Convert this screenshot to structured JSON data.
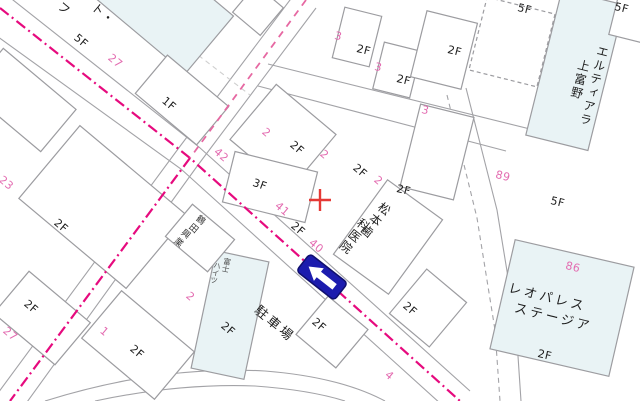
{
  "map": {
    "style": "japanese-residential-map",
    "colors": {
      "background": "#ffffff",
      "building_outline": "#9c9ca0",
      "building_fill_highlight": "#e9f3f5",
      "boundary_magenta_dashdot": "#e60a7e",
      "boundary_pink_dashed": "#e668a2",
      "lot_number_pink": "#e36bb0",
      "floor_label_black": "#1d1d1d",
      "one_way_sign_blue": "#1c1cae",
      "cross_marker_red": "#e53935"
    },
    "one_way_sign": {
      "icon": "one-way-left-arrow"
    },
    "cross_marker": {
      "symbol": "+"
    },
    "labels": [
      {
        "text": "27",
        "kind": "lot",
        "x": 113,
        "y": 52,
        "r": 40
      },
      {
        "text": "23",
        "kind": "lot",
        "x": 4,
        "y": 174,
        "r": 40
      },
      {
        "text": "42",
        "kind": "lot",
        "x": 219,
        "y": 146,
        "r": 40
      },
      {
        "text": "41",
        "kind": "lot",
        "x": 280,
        "y": 200,
        "r": 40
      },
      {
        "text": "40",
        "kind": "lot",
        "x": 314,
        "y": 237,
        "r": 40
      },
      {
        "text": "2",
        "kind": "lot",
        "x": 267,
        "y": 126,
        "r": 40
      },
      {
        "text": "2",
        "kind": "lot",
        "x": 325,
        "y": 148,
        "r": 40
      },
      {
        "text": "2",
        "kind": "lot",
        "x": 379,
        "y": 174,
        "r": 40
      },
      {
        "text": "3",
        "kind": "lot",
        "x": 336,
        "y": 30,
        "r": 14
      },
      {
        "text": "3",
        "kind": "lot",
        "x": 376,
        "y": 61,
        "r": 14
      },
      {
        "text": "3",
        "kind": "lot",
        "x": 423,
        "y": 104,
        "r": 14
      },
      {
        "text": "2",
        "kind": "lot",
        "x": 191,
        "y": 290,
        "r": 40
      },
      {
        "text": "27",
        "kind": "lot",
        "x": 8,
        "y": 325,
        "r": 40
      },
      {
        "text": "1",
        "kind": "lot",
        "x": 105,
        "y": 325,
        "r": 40
      },
      {
        "text": "89",
        "kind": "lot",
        "x": 497,
        "y": 169,
        "r": 14
      },
      {
        "text": "86",
        "kind": "lot",
        "x": 567,
        "y": 260,
        "r": 14
      },
      {
        "text": "4",
        "kind": "lot",
        "x": 390,
        "y": 369,
        "r": 40
      },
      {
        "text": "5F",
        "kind": "floor",
        "x": 79,
        "y": 32,
        "r": 40
      },
      {
        "text": "1F",
        "kind": "floor",
        "x": 167,
        "y": 95,
        "r": 40
      },
      {
        "text": "2F",
        "kind": "floor",
        "x": 59,
        "y": 217,
        "r": 40
      },
      {
        "text": "2F",
        "kind": "floor",
        "x": 29,
        "y": 298,
        "r": 40
      },
      {
        "text": "2F",
        "kind": "floor",
        "x": 135,
        "y": 343,
        "r": 40
      },
      {
        "text": "2F",
        "kind": "floor",
        "x": 226,
        "y": 320,
        "r": 40
      },
      {
        "text": "2F",
        "kind": "floor",
        "x": 317,
        "y": 316,
        "r": 40
      },
      {
        "text": "2F",
        "kind": "floor",
        "x": 408,
        "y": 300,
        "r": 40
      },
      {
        "text": "3F",
        "kind": "floor",
        "x": 255,
        "y": 177,
        "r": 20
      },
      {
        "text": "2F",
        "kind": "floor",
        "x": 295,
        "y": 139,
        "r": 40
      },
      {
        "text": "2F",
        "kind": "floor",
        "x": 296,
        "y": 220,
        "r": 40
      },
      {
        "text": "2F",
        "kind": "floor",
        "x": 358,
        "y": 162,
        "r": 40
      },
      {
        "text": "2F",
        "kind": "floor",
        "x": 398,
        "y": 183,
        "r": 14
      },
      {
        "text": "2F",
        "kind": "floor",
        "x": 358,
        "y": 43,
        "r": 14
      },
      {
        "text": "2F",
        "kind": "floor",
        "x": 398,
        "y": 73,
        "r": 14
      },
      {
        "text": "2F",
        "kind": "floor",
        "x": 449,
        "y": 44,
        "r": 14
      },
      {
        "text": "5F",
        "kind": "floor",
        "x": 519,
        "y": 2,
        "r": 14
      },
      {
        "text": "5F",
        "kind": "floor",
        "x": 616,
        "y": 1,
        "r": 14
      },
      {
        "text": "5F",
        "kind": "floor",
        "x": 552,
        "y": 195,
        "r": 14
      },
      {
        "text": "2F",
        "kind": "floor",
        "x": 539,
        "y": 348,
        "r": 13
      },
      {
        "text": "松本歯",
        "kind": "name",
        "x": 383,
        "y": 200,
        "r": 38,
        "vertical": true
      },
      {
        "text": "科医院",
        "kind": "name",
        "x": 362,
        "y": 216,
        "r": 38,
        "vertical": true
      },
      {
        "text": "駐車場",
        "kind": "name-lg",
        "x": 260,
        "y": 304,
        "r": 40
      },
      {
        "text": "レオパレス",
        "kind": "name-lg",
        "x": 510,
        "y": 282,
        "r": 14
      },
      {
        "text": "ステージア",
        "kind": "name-lg",
        "x": 516,
        "y": 302,
        "r": 14
      },
      {
        "text": "エルティアラ",
        "kind": "name",
        "x": 598,
        "y": 44,
        "r": 14,
        "vertical": true
      },
      {
        "text": "上富野",
        "kind": "name",
        "x": 579,
        "y": 58,
        "r": 14,
        "vertical": true
      },
      {
        "text": "鶴田",
        "kind": "small",
        "x": 199,
        "y": 212,
        "r": 40,
        "vertical": true
      },
      {
        "text": "興業",
        "kind": "small",
        "x": 184,
        "y": 226,
        "r": 40,
        "vertical": true
      },
      {
        "text": "富士",
        "kind": "tiny",
        "x": 224,
        "y": 257,
        "r": 12,
        "vertical": true
      },
      {
        "text": "ハイツ",
        "kind": "tiny",
        "x": 214,
        "y": 261,
        "r": 12,
        "vertical": true
      },
      {
        "text": "フ",
        "kind": "name",
        "x": 63,
        "y": 0,
        "r": 40
      },
      {
        "text": "ト・",
        "kind": "name",
        "x": 97,
        "y": 1,
        "r": 40
      }
    ]
  }
}
